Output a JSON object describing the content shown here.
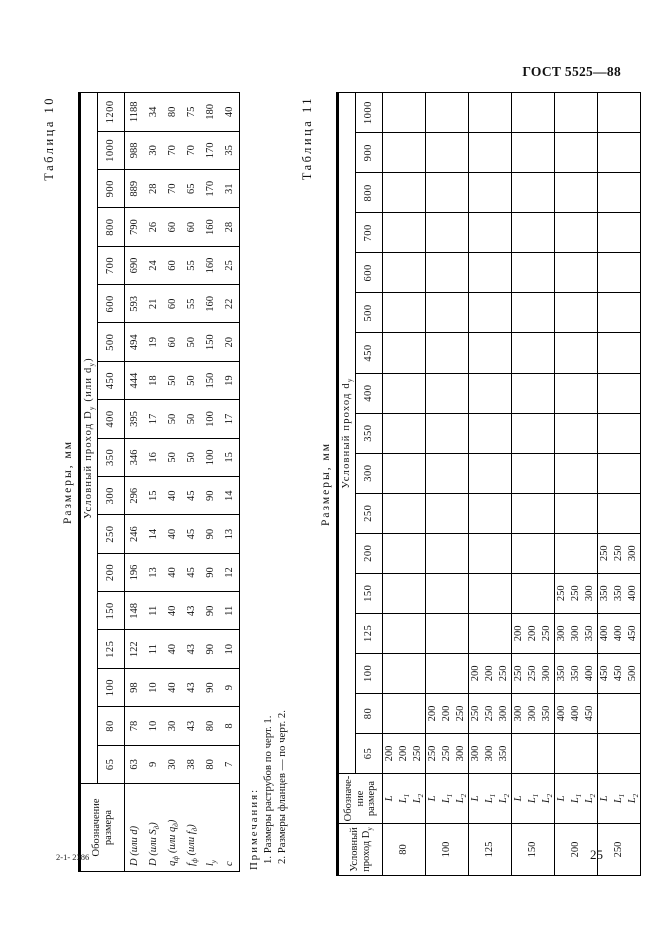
{
  "page": {
    "header_right": "ГОСТ 5525—88",
    "footer_left": "2-1- 2386",
    "page_number": "25"
  },
  "table10": {
    "label": "Таблица 10",
    "units_title": "Размеры, мм",
    "row_header": "Обозначение размера",
    "col_group_header": "Условный проход D~у~ (или d~у~)",
    "columns": [
      "65",
      "80",
      "100",
      "125",
      "150",
      "200",
      "250",
      "300",
      "350",
      "400",
      "450",
      "500",
      "600",
      "700",
      "800",
      "900",
      "1000",
      "1200"
    ],
    "rows": [
      {
        "label": "D (или d)",
        "values": [
          "63",
          "78",
          "98",
          "122",
          "148",
          "196",
          "246",
          "296",
          "346",
          "395",
          "444",
          "494",
          "593",
          "690",
          "790",
          "889",
          "988",
          "1188"
        ]
      },
      {
        "label": "D (или S~д~)",
        "values": [
          "9",
          "10",
          "10",
          "11",
          "11",
          "13",
          "14",
          "15",
          "16",
          "17",
          "18",
          "19",
          "21",
          "24",
          "26",
          "28",
          "30",
          "34"
        ]
      },
      {
        "label": "q~ф~ (или q~д~)",
        "values": [
          "30",
          "30",
          "40",
          "40",
          "40",
          "40",
          "40",
          "40",
          "50",
          "50",
          "50",
          "60",
          "60",
          "60",
          "60",
          "70",
          "70",
          "80"
        ]
      },
      {
        "label": "f~ф~ (или f~д~)",
        "values": [
          "38",
          "43",
          "43",
          "43",
          "43",
          "45",
          "45",
          "45",
          "50",
          "50",
          "50",
          "50",
          "55",
          "55",
          "60",
          "65",
          "70",
          "75"
        ]
      },
      {
        "label": "l~у~",
        "values": [
          "80",
          "80",
          "90",
          "90",
          "90",
          "90",
          "90",
          "90",
          "100",
          "100",
          "150",
          "150",
          "160",
          "160",
          "160",
          "170",
          "170",
          "180"
        ]
      },
      {
        "label": "с",
        "values": [
          "7",
          "8",
          "9",
          "10",
          "11",
          "12",
          "13",
          "14",
          "15",
          "17",
          "19",
          "20",
          "22",
          "25",
          "28",
          "31",
          "35",
          "40"
        ]
      }
    ],
    "notes_title": "Примечания:",
    "notes": [
      "1. Размеры раструбов по черт. 1.",
      "2. Размеры фланцев — по черт. 2."
    ]
  },
  "table11": {
    "label": "Таблица 11",
    "units_title": "Размеры, мм",
    "row_header1": "Условный проход D~у~",
    "row_header2": "Обозначе-\nние размера",
    "col_group_header": "Условный проход d~у~",
    "columns": [
      "65",
      "80",
      "100",
      "125",
      "150",
      "200",
      "250",
      "300",
      "350",
      "400",
      "450",
      "500",
      "600",
      "700",
      "800",
      "900",
      "1000"
    ],
    "groups": [
      {
        "dn": "80",
        "rows": [
          {
            "label": "L",
            "values": [
              "200",
              "",
              "",
              "",
              "",
              "",
              "",
              "",
              "",
              "",
              "",
              "",
              "",
              "",
              "",
              "",
              ""
            ]
          },
          {
            "label": "L~1~",
            "values": [
              "200",
              "",
              "",
              "",
              "",
              "",
              "",
              "",
              "",
              "",
              "",
              "",
              "",
              "",
              "",
              "",
              ""
            ]
          },
          {
            "label": "L~2~",
            "values": [
              "250",
              "",
              "",
              "",
              "",
              "",
              "",
              "",
              "",
              "",
              "",
              "",
              "",
              "",
              "",
              "",
              ""
            ]
          }
        ]
      },
      {
        "dn": "100",
        "rows": [
          {
            "label": "L",
            "values": [
              "250",
              "200",
              "",
              "",
              "",
              "",
              "",
              "",
              "",
              "",
              "",
              "",
              "",
              "",
              "",
              "",
              ""
            ]
          },
          {
            "label": "L~1~",
            "values": [
              "250",
              "200",
              "",
              "",
              "",
              "",
              "",
              "",
              "",
              "",
              "",
              "",
              "",
              "",
              "",
              "",
              ""
            ]
          },
          {
            "label": "L~2~",
            "values": [
              "300",
              "250",
              "",
              "",
              "",
              "",
              "",
              "",
              "",
              "",
              "",
              "",
              "",
              "",
              "",
              "",
              ""
            ]
          }
        ]
      },
      {
        "dn": "125",
        "rows": [
          {
            "label": "L",
            "values": [
              "300",
              "250",
              "200",
              "",
              "",
              "",
              "",
              "",
              "",
              "",
              "",
              "",
              "",
              "",
              "",
              "",
              ""
            ]
          },
          {
            "label": "L~1~",
            "values": [
              "300",
              "250",
              "200",
              "",
              "",
              "",
              "",
              "",
              "",
              "",
              "",
              "",
              "",
              "",
              "",
              "",
              ""
            ]
          },
          {
            "label": "L~2~",
            "values": [
              "350",
              "300",
              "250",
              "",
              "",
              "",
              "",
              "",
              "",
              "",
              "",
              "",
              "",
              "",
              "",
              "",
              ""
            ]
          }
        ]
      },
      {
        "dn": "150",
        "rows": [
          {
            "label": "L",
            "values": [
              "",
              "300",
              "250",
              "200",
              "",
              "",
              "",
              "",
              "",
              "",
              "",
              "",
              "",
              "",
              "",
              "",
              ""
            ]
          },
          {
            "label": "L~1~",
            "values": [
              "",
              "300",
              "250",
              "200",
              "",
              "",
              "",
              "",
              "",
              "",
              "",
              "",
              "",
              "",
              "",
              "",
              ""
            ]
          },
          {
            "label": "L~2~",
            "values": [
              "",
              "350",
              "300",
              "250",
              "",
              "",
              "",
              "",
              "",
              "",
              "",
              "",
              "",
              "",
              "",
              "",
              ""
            ]
          }
        ]
      },
      {
        "dn": "200",
        "rows": [
          {
            "label": "L",
            "values": [
              "",
              "400",
              "350",
              "300",
              "250",
              "",
              "",
              "",
              "",
              "",
              "",
              "",
              "",
              "",
              "",
              "",
              ""
            ]
          },
          {
            "label": "L~1~",
            "values": [
              "",
              "400",
              "350",
              "300",
              "250",
              "",
              "",
              "",
              "",
              "",
              "",
              "",
              "",
              "",
              "",
              "",
              ""
            ]
          },
          {
            "label": "L~2~",
            "values": [
              "",
              "450",
              "400",
              "350",
              "300",
              "",
              "",
              "",
              "",
              "",
              "",
              "",
              "",
              "",
              "",
              "",
              ""
            ]
          }
        ]
      },
      {
        "dn": "250",
        "rows": [
          {
            "label": "L",
            "values": [
              "",
              "",
              "450",
              "400",
              "350",
              "250",
              "",
              "",
              "",
              "",
              "",
              "",
              "",
              "",
              "",
              "",
              ""
            ]
          },
          {
            "label": "L~1~",
            "values": [
              "",
              "",
              "450",
              "400",
              "350",
              "250",
              "",
              "",
              "",
              "",
              "",
              "",
              "",
              "",
              "",
              "",
              ""
            ]
          },
          {
            "label": "L~2~",
            "values": [
              "",
              "",
              "500",
              "450",
              "400",
              "300",
              "",
              "",
              "",
              "",
              "",
              "",
              "",
              "",
              "",
              "",
              ""
            ]
          }
        ]
      }
    ]
  }
}
